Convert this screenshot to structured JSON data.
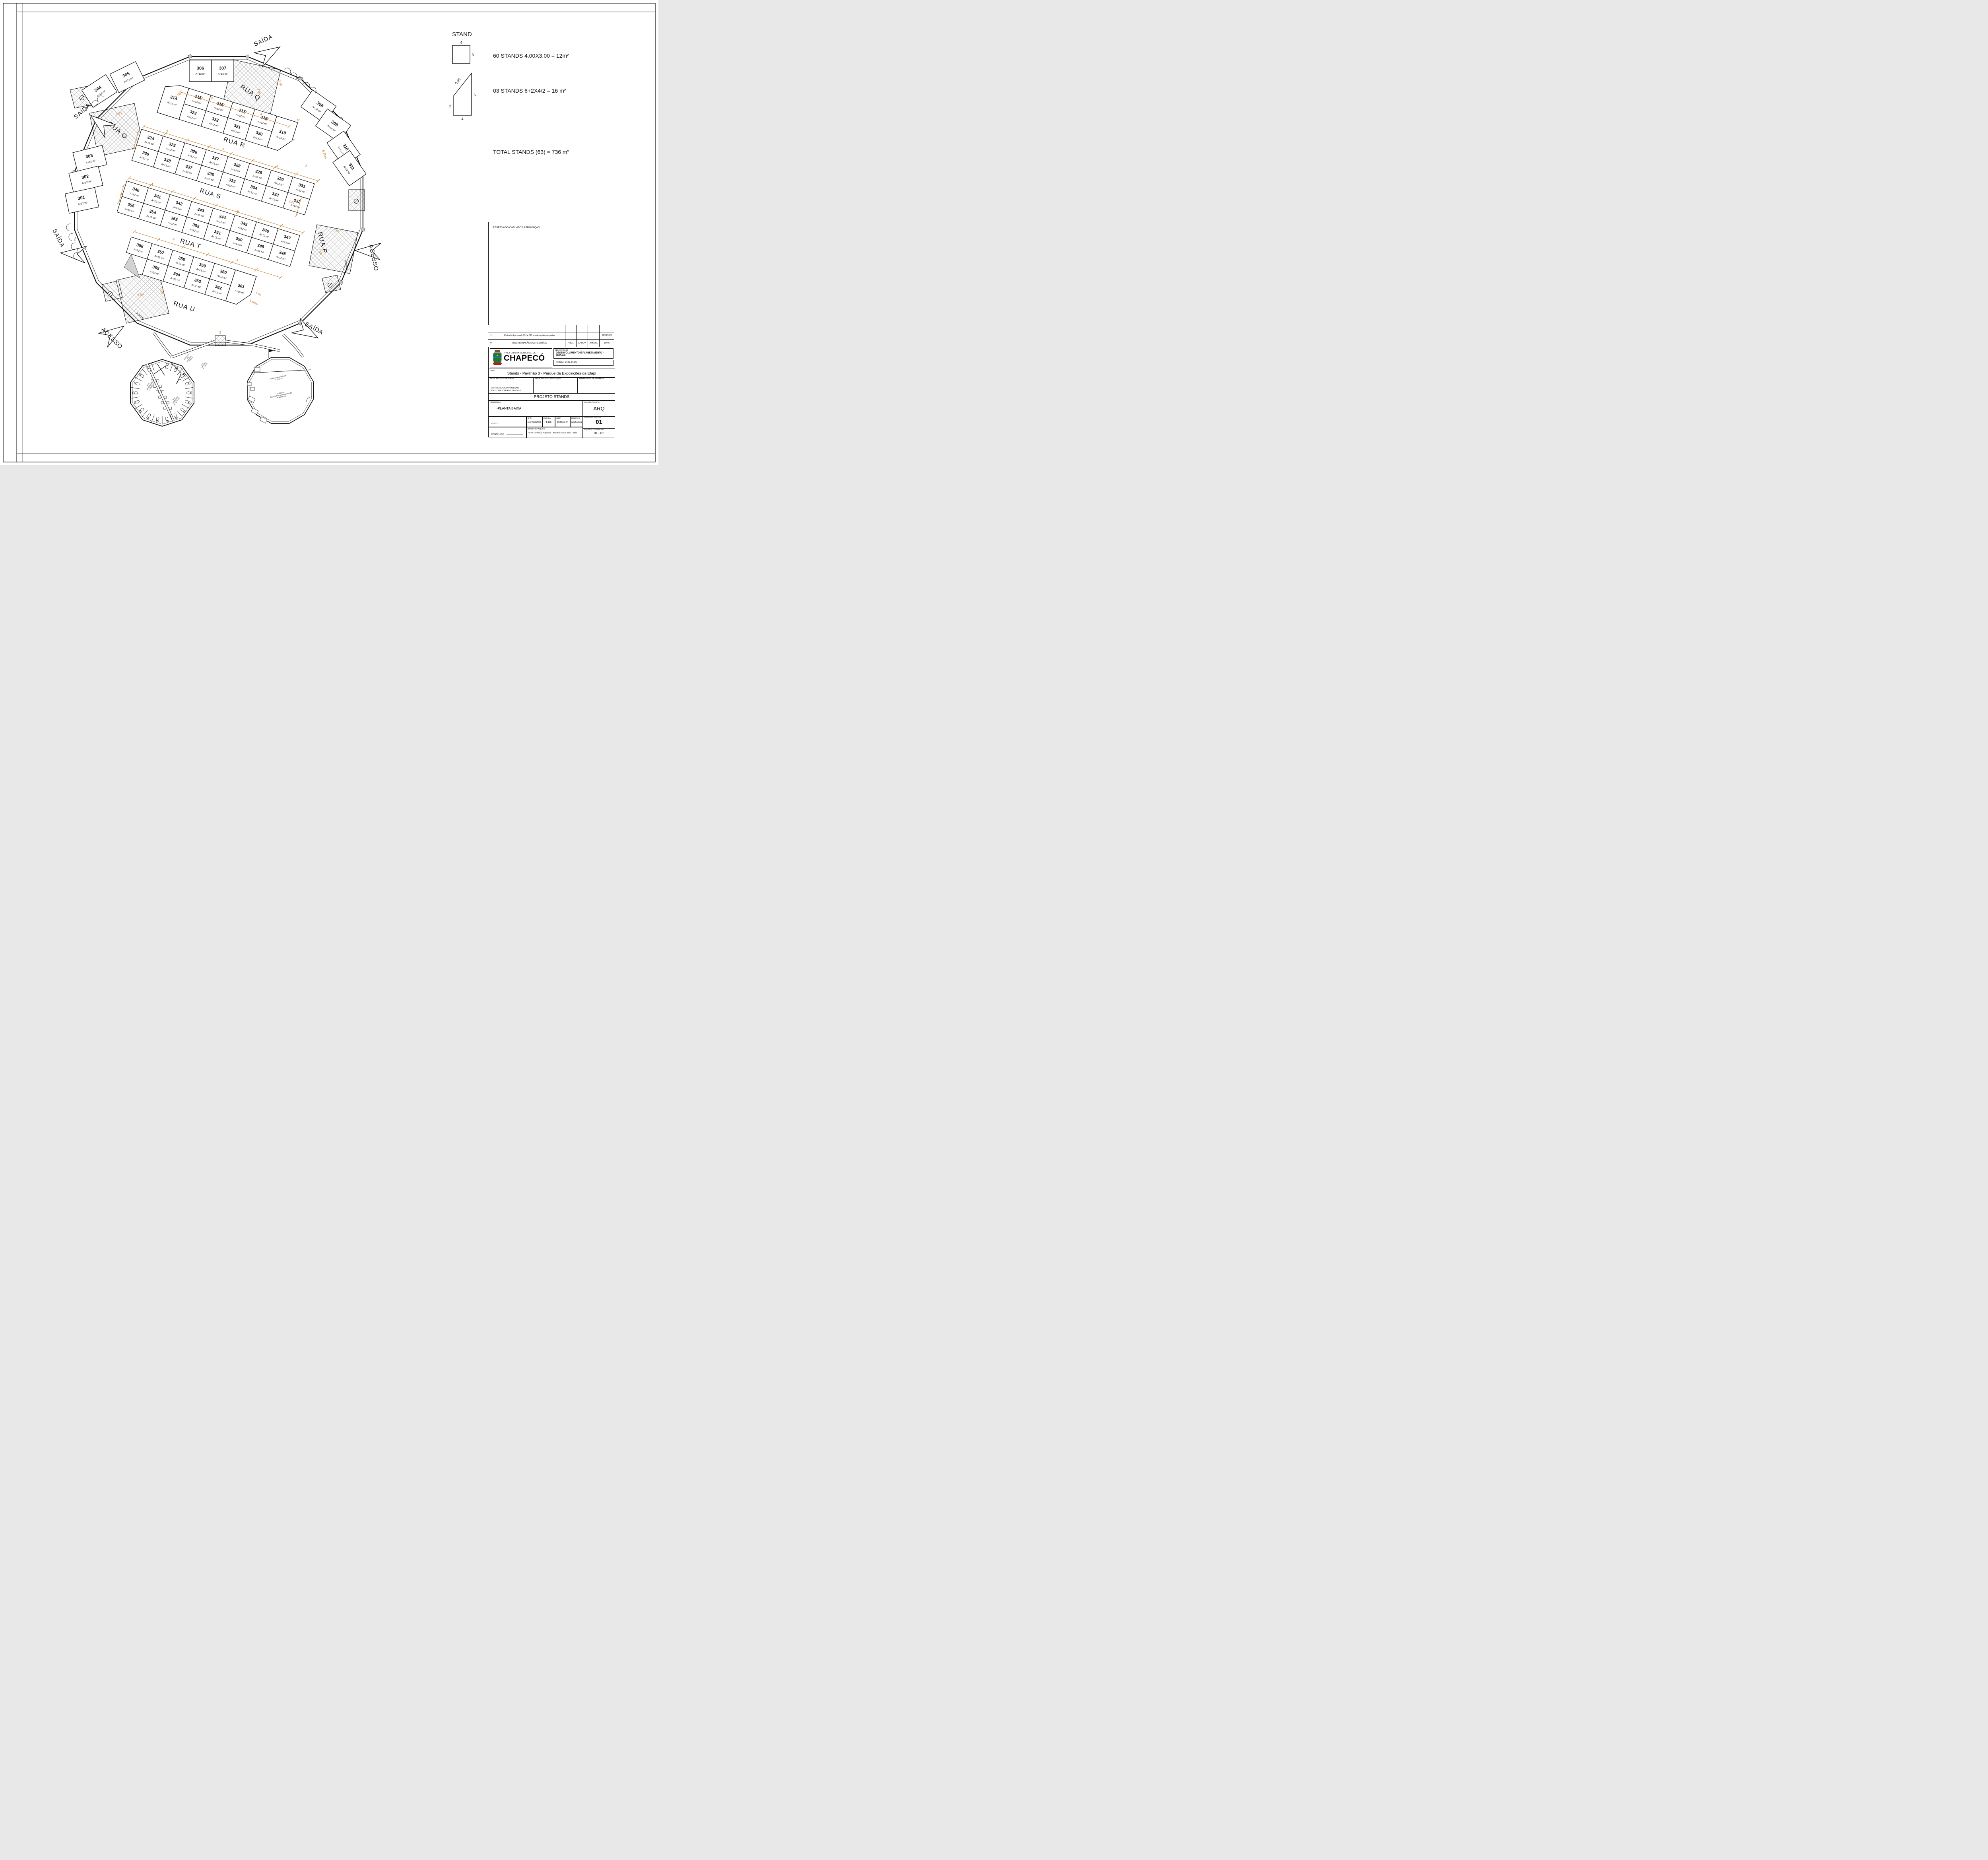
{
  "legend": {
    "title": "STAND",
    "square": {
      "top": "4",
      "right": "3"
    },
    "trapezoid": {
      "diag": "5,66",
      "right": "6",
      "left": "2",
      "bottom": "4"
    },
    "line1": "60 STANDS 4.00X3.00 = 12m²",
    "line2": "03 STANDS 6+2X4/2 = 16 m²",
    "total": "TOTAL STANDS (63) = 736 m²"
  },
  "approval_box": {
    "label": "RESERVADO CARIMBOS APROVAÇÃO"
  },
  "revisions": {
    "header": {
      "n": "N°",
      "desc": "DISCRIMINAÇÃO DAS REVISÕES",
      "proj": "PROJ.",
      "aprov1": "APROV.",
      "aprov2": "APROV.",
      "data": "DATA"
    },
    "rows": [
      {
        "n": "1",
        "desc": "Retirada dos stands 312 e 313 e realocação das portas",
        "proj": "",
        "aprov1": "",
        "aprov2": "",
        "data": "20/03/2023"
      }
    ]
  },
  "title_block": {
    "org_line1": "PREFEITURA MUNICIPAL DE",
    "org_name": "CHAPECÓ",
    "secretaria_label": "SECRETARIA DE",
    "secretaria": "DESENVOLVIMENTO E PLANEJAMENTO - SEPLAD",
    "obras": "OBRAS PÚBLICAS",
    "obra_label": "OBRA",
    "obra": "Stands - Pavilhão 3 - Parque da Exposições da Efapi",
    "resp_proj_label": "RESP. TÉCNICO PROJETO",
    "resp_proj_name": "LARISSA SAUGO PIOVESAN",
    "resp_proj_reg": "ENG. CIVIL CREA/SC 140751-5",
    "resp_exec_label": "RESP. TÉCNICO EXECUÇÃO",
    "pref_label": "PREFEITURA DE CHAPECÓ",
    "project_title": "PROJETO STANDS",
    "ref_label": "REFERÊNCIA",
    "ref_value": "-PLANTA BAIXA",
    "sigla_label": "SIGLA DO PROJETO",
    "sigla": "ARQ",
    "prancha_label": "NUMERO DA PRANCHA",
    "prancha": "01",
    "seq_label": "SEQUÊNCIA DAS PRANCHAS",
    "seq": "01 - 01",
    "visto_label": "VISTO",
    "concluido_label": "CONCLUIDO",
    "data_label": "DATA",
    "data": "MARÇO/2023",
    "escala_label": "ESCALA",
    "escala": "1:125",
    "area_label": "ÁREA",
    "area": "1932,59 m²",
    "desenho_label": "DESENHO",
    "desenho": "Ana/Larissa",
    "arquivo_label": "DESENHO/ARQUIVO",
    "arquivo": "Y:\\SP-Larissa\\3. Projetos\\2 - Projetos Stands Efapi - 2023"
  },
  "plan": {
    "default_area": "A=12 m²",
    "area16": "A=16 m²",
    "streets": {
      "rua-o": "RUA O",
      "rua-p": "RUA P",
      "rua-q": "RUA Q",
      "rua-r": "RUA R",
      "rua-s": "RUA S",
      "rua-t": "RUA T",
      "rua-u": "RUA U"
    },
    "exit_labels": {
      "saida": "SAÍDA",
      "acesso": "ACESSO",
      "portao": "PORTÃO"
    },
    "bands": [
      {
        "name": "band-q-r",
        "left_cap": {
          "n": "314",
          "a16": true
        },
        "right_cap": {
          "n": "319",
          "a16": true
        },
        "top": [
          "315",
          "316",
          "317",
          "318"
        ],
        "bottom": [
          "323",
          "322",
          "321",
          "320"
        ]
      },
      {
        "name": "band-r-s",
        "top": [
          "324",
          "325",
          "326",
          "327",
          "328",
          "329",
          "330",
          "331"
        ],
        "bottom": [
          "339",
          "338",
          "337",
          "336",
          "335",
          "334",
          "333",
          "332"
        ]
      },
      {
        "name": "band-s-t",
        "top": [
          "340",
          "341",
          "342",
          "343",
          "344",
          "345",
          "346",
          "347"
        ],
        "bottom": [
          "355",
          "354",
          "353",
          "352",
          "351",
          "350",
          "349",
          "348"
        ]
      },
      {
        "name": "band-t-u",
        "right_cap": {
          "n": "361",
          "a16": true
        },
        "top": [
          "356",
          "357",
          "358",
          "359",
          "360"
        ],
        "bottom": [
          "365",
          "364",
          "363",
          "362"
        ]
      }
    ],
    "perimeter_stands": [
      "304",
      "305",
      "306",
      "307",
      "308",
      "309",
      "310",
      "311",
      "303",
      "302",
      "301"
    ],
    "dimensions": {
      "d2": "2",
      "d3": "3",
      "d4": "4",
      "d6": "6",
      "d401": "4.01",
      "d566": "5.66m",
      "d705": "7.05",
      "d706": "7.06",
      "d707": "7.07"
    },
    "facilities": {
      "wc_masculino": "W.C\nMASCULINO\nA: 30,45 m2",
      "wc_feminino": "W.C\nFEMININO\nA: 30,45 m2",
      "wc_pne": "W.C\nPNE\nA: 2,7 m²",
      "hall_metalico": "METALICO\nHALL\nEXTERNO\nA: 7,95 m2",
      "hall_externo": "HALL\nEXTERNO\nA: 7,86 m2",
      "cozinha": "COZINHA\nÁrea de Preparo/Higienização\nA: 85,45 m2",
      "comercializacao": "Área de Comercialização\nA: 10,10 m²"
    }
  }
}
